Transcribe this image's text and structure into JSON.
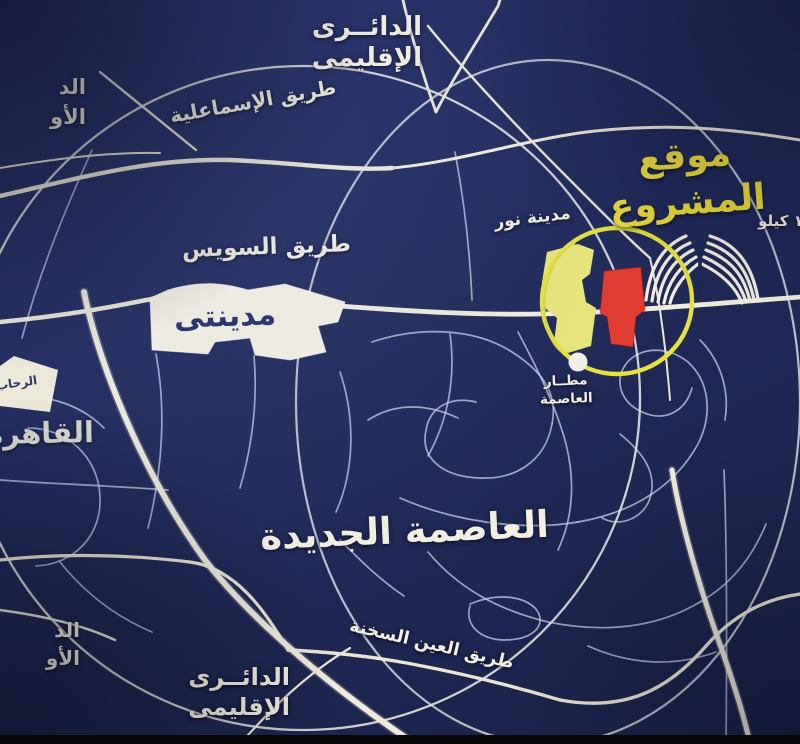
{
  "map": {
    "title_context": "خريطة موقع المشروع",
    "labels": {
      "ring_road_top_line1": "الدائــرى",
      "ring_road_top_line2": "الإقليمى",
      "edge_top_left_line1": "الد",
      "edge_top_left_line2": "الأو",
      "ismailia_road": "طريق الإسماعلية",
      "suez_road": "طريق السويس",
      "madinaty": "مدينتى",
      "rehab": "الرحاب",
      "cairo": "القاهرة",
      "project_line1": "موقع",
      "project_line2": "المشروع",
      "distance_kilo": "١٢ كيلو",
      "nour_city": "مدينة نور",
      "airport_line1": "مطــار",
      "airport_line2": "العاصمة",
      "new_capital": "العاصمة الجديدة",
      "sokhna_road": "طريق العين السخنة",
      "ring_road_bottom_line1": "الدائــرى",
      "ring_road_bottom_line2": "الإقليمى",
      "edge_bottom_left_line1": "الد",
      "edge_bottom_left_line2": "الأو"
    },
    "colors": {
      "background": "#212b5c",
      "major_road": "#efecdd",
      "minor_road": "#cfd8ef",
      "highlight_circle": "#e6e23e",
      "project_fill": "#e23b30",
      "nour_city_fill": "#e9e57a",
      "city_polygon_fill": "#f5f1e2",
      "project_label_yellow": "#eddc3c",
      "label_white": "#f2efe3",
      "madinaty_text": "#233067"
    }
  }
}
